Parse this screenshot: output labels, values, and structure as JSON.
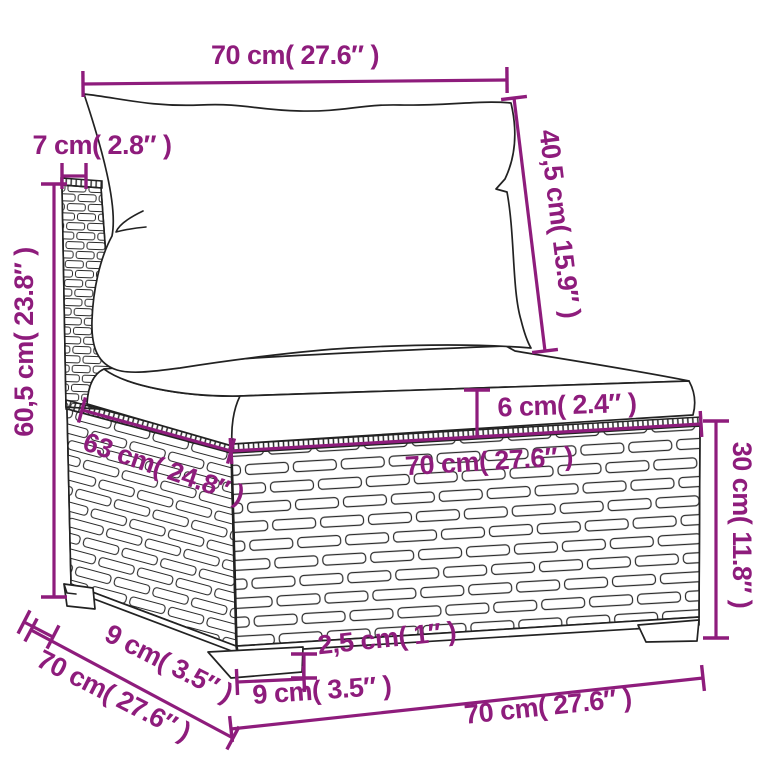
{
  "colors": {
    "dimension": "#8E1C7C",
    "sketch": "#222222",
    "background": "#FFFFFF"
  },
  "labels": {
    "back_width": "70 cm( 27.6″ )",
    "post_top_depth": "7 cm( 2.8″ )",
    "back_cushion_height": "40,5 cm( 15.9″ )",
    "back_height": "60,5 cm( 23.8″ )",
    "seat_depth": "63 cm( 24.8″ )",
    "seat_width": "70 cm( 27.6″ )",
    "seat_cushion_thickness": "6 cm( 2.4″ )",
    "base_height": "30 cm( 11.8″ )",
    "foot_depth": "9 cm( 3.5″ )",
    "total_depth": "70 cm( 27.6″ )",
    "foot_width": "9 cm( 3.5″ )",
    "foot_height": "2,5 cm( 1″ )",
    "base_width": "70 cm( 27.6″ )"
  }
}
